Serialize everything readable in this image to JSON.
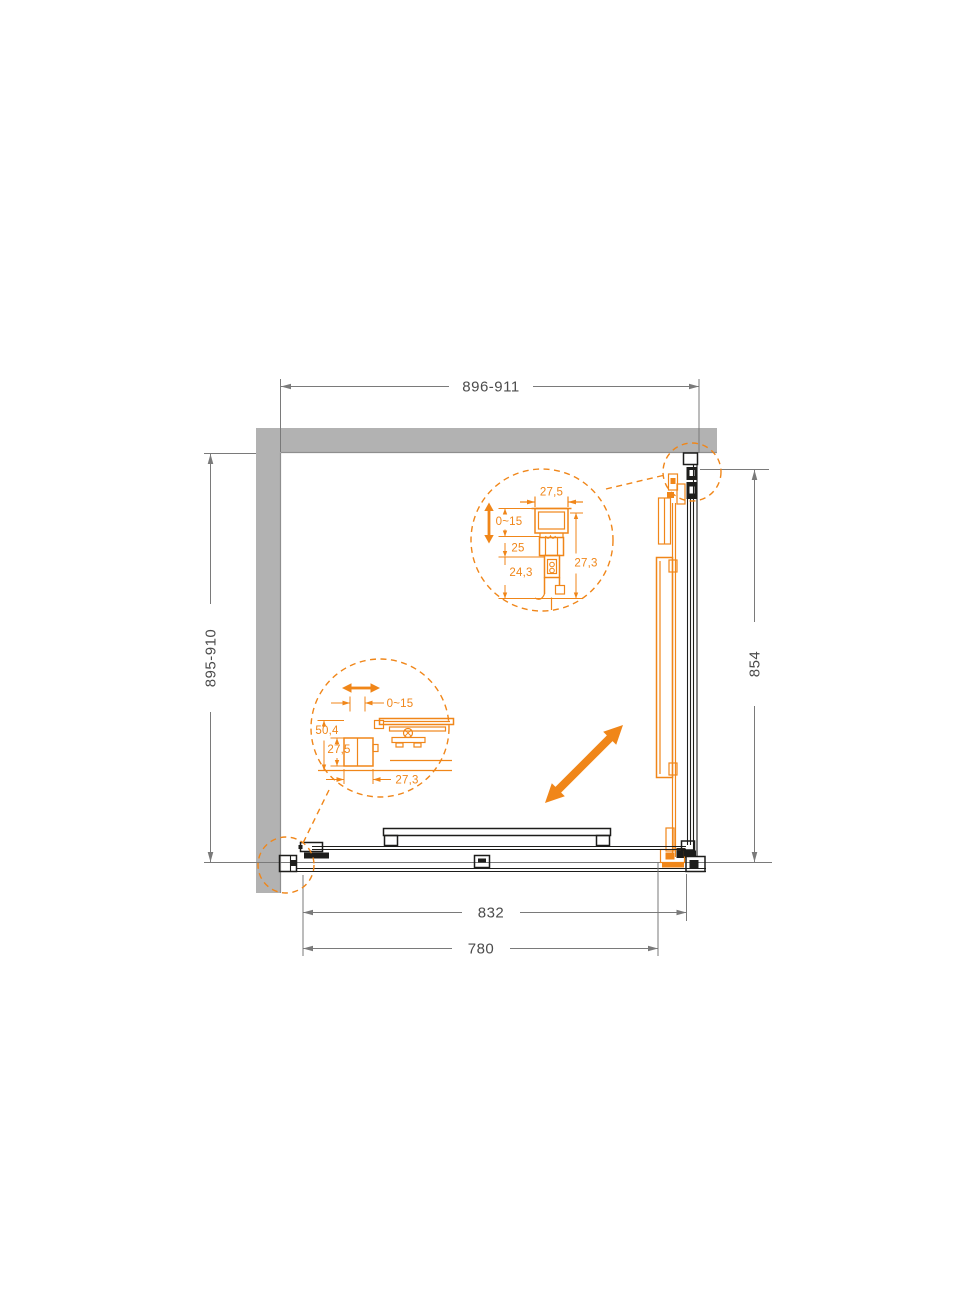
{
  "colors": {
    "accent": "#F08619",
    "wall": "#B2B2B2",
    "wall_edge": "#8E8E8E",
    "profile": "#1D1D1B",
    "dim_line": "#7A7A7A",
    "dim_text": "#4C4C4C",
    "bg": "#FFFFFF"
  },
  "drawing": {
    "dim_top": "896-911",
    "dim_left": "895-910",
    "dim_right": "854",
    "dim_bottom_outer": "832",
    "dim_bottom_inner": "780"
  },
  "detail_top": {
    "profile_width": "27,5",
    "adjust_range": "0~15",
    "offset_mid": "25",
    "offset_lower": "24,3",
    "profile_depth": "27,3"
  },
  "detail_bottom": {
    "adjust_range": "0~15",
    "assembly_height": "50,4",
    "profile_height": "27,5",
    "profile_width": "27,3"
  }
}
